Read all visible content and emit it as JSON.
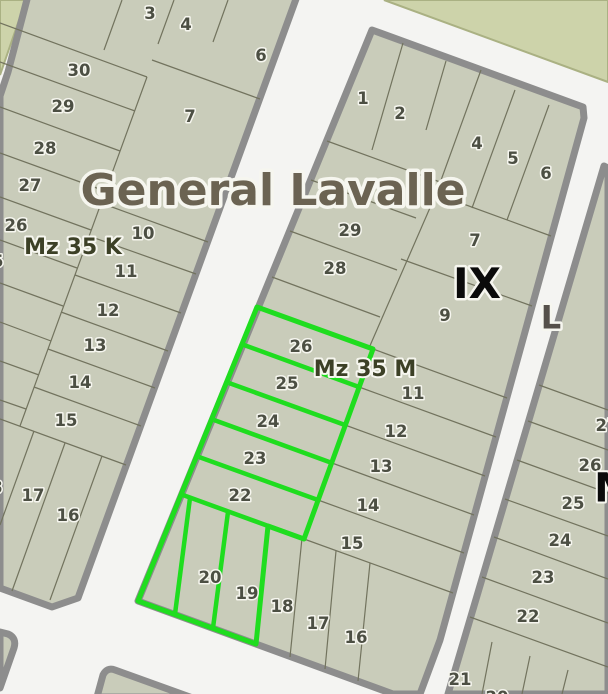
{
  "map": {
    "title": "General Lavalle",
    "district_labels": {
      "k": "Mz 35 K",
      "m": "Mz 35 M"
    },
    "zone_label": "IX",
    "street_label": "L",
    "partial_zone_label": "M",
    "selection": {
      "highlighted_lots": [
        "26",
        "25",
        "24",
        "23",
        "22",
        "20",
        "19"
      ],
      "color": "#1fdd1f"
    },
    "colors": {
      "street": "#f4f4f2",
      "parcel_fill": "#c9ccba",
      "block_border": "#8d8d8d",
      "parcel_line": "#72735e",
      "highlight_green": "#1fdd1f",
      "field_fill": "#cdd3aa",
      "field_border": "#aab183",
      "number_text": "#4c4f43",
      "district_text": "#3c4026",
      "title_text": "#6b6352",
      "zone_text": "#0b0b0b",
      "street_label_text": "#55504a",
      "halo": "#f6f6ef"
    },
    "blocks": {
      "left": {
        "district_label": {
          "t": "Mz 35 K",
          "x": 73,
          "y": 246
        },
        "lots": [
          {
            "t": "3",
            "x": 150,
            "y": 13
          },
          {
            "t": "4",
            "x": 186,
            "y": 24
          },
          {
            "t": "6",
            "x": 261,
            "y": 55
          },
          {
            "t": "30",
            "x": 79,
            "y": 70
          },
          {
            "t": "29",
            "x": 63,
            "y": 106
          },
          {
            "t": "7",
            "x": 190,
            "y": 116
          },
          {
            "t": "28",
            "x": 45,
            "y": 148
          },
          {
            "t": "27",
            "x": 30,
            "y": 185
          },
          {
            "t": "26",
            "x": 16,
            "y": 225
          },
          {
            "t": "25",
            "x": -8,
            "y": 261
          },
          {
            "t": "10",
            "x": 143,
            "y": 233
          },
          {
            "t": "11",
            "x": 126,
            "y": 271
          },
          {
            "t": "12",
            "x": 108,
            "y": 310
          },
          {
            "t": "13",
            "x": 95,
            "y": 345
          },
          {
            "t": "14",
            "x": 80,
            "y": 382
          },
          {
            "t": "15",
            "x": 66,
            "y": 420
          },
          {
            "t": "18",
            "x": -9,
            "y": 487
          },
          {
            "t": "17",
            "x": 33,
            "y": 495
          },
          {
            "t": "16",
            "x": 68,
            "y": 515
          }
        ]
      },
      "middle": {
        "district_label": {
          "t": "Mz 35 M",
          "x": 365,
          "y": 368
        },
        "zone_label": {
          "t": "IX",
          "x": 477,
          "y": 283
        },
        "lots": [
          {
            "t": "1",
            "x": 363,
            "y": 98
          },
          {
            "t": "2",
            "x": 400,
            "y": 113
          },
          {
            "t": "4",
            "x": 477,
            "y": 143
          },
          {
            "t": "5",
            "x": 513,
            "y": 158
          },
          {
            "t": "6",
            "x": 546,
            "y": 173
          },
          {
            "t": "29",
            "x": 350,
            "y": 230
          },
          {
            "t": "7",
            "x": 475,
            "y": 240
          },
          {
            "t": "28",
            "x": 335,
            "y": 268
          },
          {
            "t": "9",
            "x": 445,
            "y": 315
          },
          {
            "t": "26",
            "x": 301,
            "y": 346
          },
          {
            "t": "25",
            "x": 287,
            "y": 383
          },
          {
            "t": "11",
            "x": 413,
            "y": 393
          },
          {
            "t": "24",
            "x": 268,
            "y": 421
          },
          {
            "t": "12",
            "x": 396,
            "y": 431
          },
          {
            "t": "23",
            "x": 255,
            "y": 458
          },
          {
            "t": "13",
            "x": 381,
            "y": 466
          },
          {
            "t": "22",
            "x": 240,
            "y": 495
          },
          {
            "t": "14",
            "x": 368,
            "y": 505
          },
          {
            "t": "15",
            "x": 352,
            "y": 543
          },
          {
            "t": "20",
            "x": 210,
            "y": 577
          },
          {
            "t": "19",
            "x": 247,
            "y": 593
          },
          {
            "t": "18",
            "x": 282,
            "y": 606
          },
          {
            "t": "17",
            "x": 318,
            "y": 623
          },
          {
            "t": "16",
            "x": 356,
            "y": 637
          }
        ]
      },
      "right": {
        "street_label": {
          "t": "L",
          "x": 551,
          "y": 317
        },
        "partial_zone_label": {
          "t": "M",
          "x": 614,
          "y": 487
        },
        "lots": [
          {
            "t": "27",
            "x": 607,
            "y": 425
          },
          {
            "t": "26",
            "x": 590,
            "y": 465
          },
          {
            "t": "25",
            "x": 573,
            "y": 503
          },
          {
            "t": "24",
            "x": 560,
            "y": 540
          },
          {
            "t": "23",
            "x": 543,
            "y": 577
          },
          {
            "t": "22",
            "x": 528,
            "y": 616
          },
          {
            "t": "21",
            "x": 460,
            "y": 679
          },
          {
            "t": "20",
            "x": 497,
            "y": 697
          }
        ]
      }
    }
  }
}
